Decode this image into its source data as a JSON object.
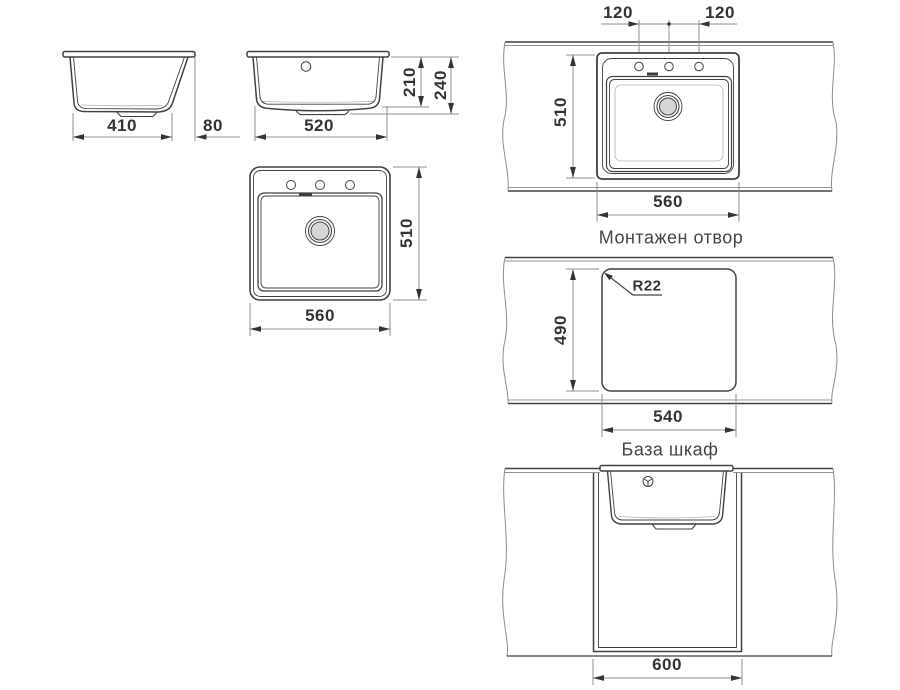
{
  "views": {
    "side": {
      "width": "410",
      "rear_deck": "80"
    },
    "front": {
      "width": "520",
      "bowl_depth": "210",
      "total_depth": "240"
    },
    "top": {
      "width": "560",
      "depth": "510"
    },
    "mount": {
      "hole_spacing_left": "120",
      "hole_spacing_right": "120",
      "depth": "510",
      "width": "560",
      "label": "Монтажен отвор"
    },
    "cutout": {
      "corner_radius": "R22",
      "depth": "490",
      "width": "540",
      "label": "База шкаф"
    },
    "cabinet": {
      "width": "600"
    }
  },
  "colors": {
    "outline": "#414141",
    "dimension_line": "#8f8f8f",
    "dimension_text": "#333333",
    "label_text": "#454545",
    "drain_fill": "#d6d6d6",
    "background": "#ffffff"
  }
}
